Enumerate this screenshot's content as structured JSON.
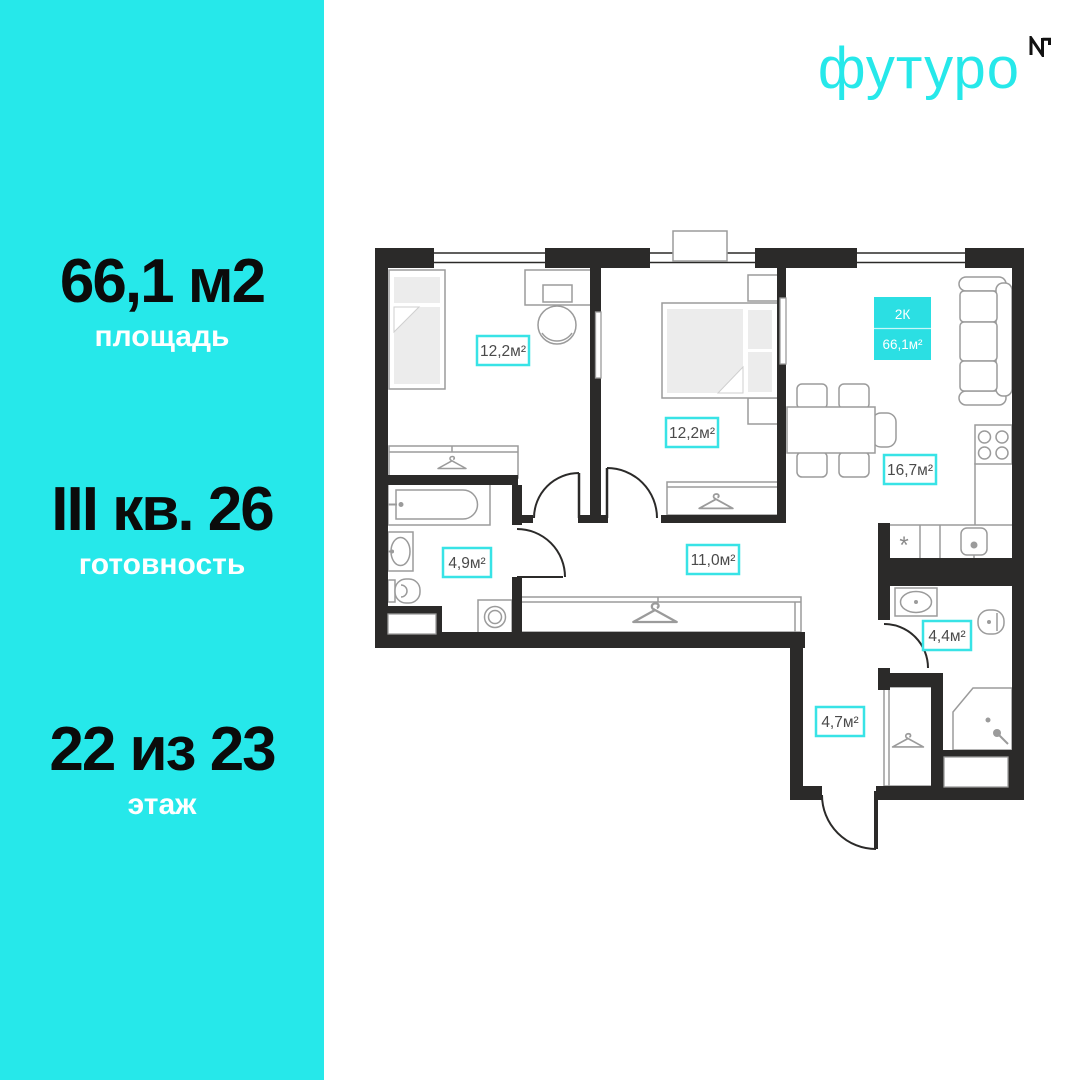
{
  "brand": {
    "name": "футуро",
    "monogram": "NT"
  },
  "sidebar": {
    "stats": [
      {
        "value": "66,1 м2",
        "label": "площадь"
      },
      {
        "value": "III кв. 26",
        "label": "готовность"
      },
      {
        "value": "22 из 23",
        "label": "этаж"
      }
    ]
  },
  "plan": {
    "badge": {
      "rooms_type": "2К",
      "total_area": "66,1м²"
    },
    "rooms": [
      {
        "id": "bedroom-1",
        "area_label": "12,2м²"
      },
      {
        "id": "bedroom-2",
        "area_label": "12,2м²"
      },
      {
        "id": "kitchen-living-room",
        "area_label": "16,7м²"
      },
      {
        "id": "hallway",
        "area_label": "11,0м²"
      },
      {
        "id": "bathroom",
        "area_label": "4,9м²"
      },
      {
        "id": "second-bathroom",
        "area_label": "4,4м²"
      },
      {
        "id": "entry-corridor",
        "area_label": "4,7м²"
      }
    ],
    "appliance_marker": "*",
    "colors": {
      "accent_cyan": "#26e8ea",
      "badge_fill": "#2bdfe3",
      "label_border": "#38e3e6",
      "wall": "#2b2a29",
      "furniture_line": "#9b9b9b"
    }
  }
}
